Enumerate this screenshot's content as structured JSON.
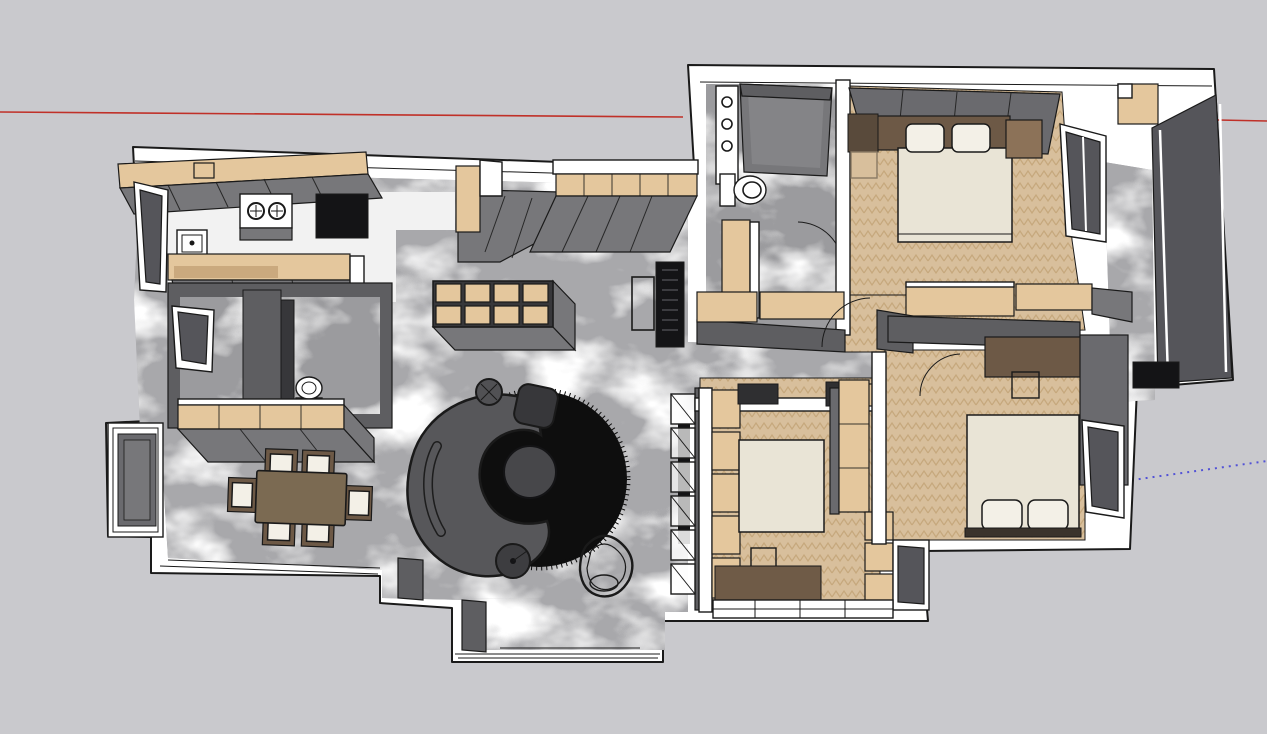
{
  "scene": {
    "type": "sketchup-style 3d floor plan, top view",
    "rooms": [
      {
        "name": "kitchen",
        "floor": "white tile"
      },
      {
        "name": "living-dining-hall",
        "floor": "gray marble"
      },
      {
        "name": "guest-bathroom",
        "floor": "dark marble"
      },
      {
        "name": "master-bathroom",
        "floor": "dark marble"
      },
      {
        "name": "master-bedroom",
        "floor": "herringbone wood"
      },
      {
        "name": "middle-bedroom",
        "floor": "herringbone wood"
      },
      {
        "name": "right-bedroom",
        "floor": "herringbone wood"
      },
      {
        "name": "right-balcony",
        "floor": "gray marble"
      },
      {
        "name": "bottom-bay",
        "floor": "gray marble"
      }
    ],
    "furniture_counts": {
      "dining_chairs": 6,
      "beds": 3,
      "shelf_cubbies": 8,
      "hall_cabinet_doors": 5,
      "shoe_cabinet_cells": 6,
      "stove_burners": 2
    },
    "axes": {
      "red_axis_left": {
        "x1": 0,
        "y1": 112,
        "x2": 683,
        "y2": 117
      },
      "red_axis_right": {
        "x1": 1218,
        "y1": 120,
        "x2": 1267,
        "y2": 121
      },
      "blue_axis_dotted": {
        "x1": 1104,
        "y1": 484,
        "x2": 1267,
        "y2": 461
      }
    }
  },
  "colors": {
    "bg": "#c9c9cd",
    "axis-red": "#c03028",
    "axis-blue": "#5252d6",
    "wall": "#ffffff",
    "outline": "#1a1a1a",
    "marble": "#a8a8ab",
    "marble-dark": "#9b9b9e",
    "kitchen-floor": "#f2f2f2",
    "wood": "#e4c79d",
    "wood-dark": "#caa97e",
    "wood-floor": "#d8bf9c",
    "wood-floor-line": "#c2a276",
    "gray-face": "#77777a",
    "gray-face-dark": "#5e5e61",
    "wardrobe": "#6a6a6e",
    "glass": "#55555a",
    "cream": "#e9e4d6",
    "pillow": "#f3f0e7",
    "brown": "#6d5946",
    "brown-mid": "#8c7258",
    "table-brown": "#7b6a52",
    "rug-brown": "#6f5b47",
    "sofa": "#57575a",
    "rug-black": "#0e0e0e",
    "pouf": "#37373a",
    "black": "#141416"
  }
}
